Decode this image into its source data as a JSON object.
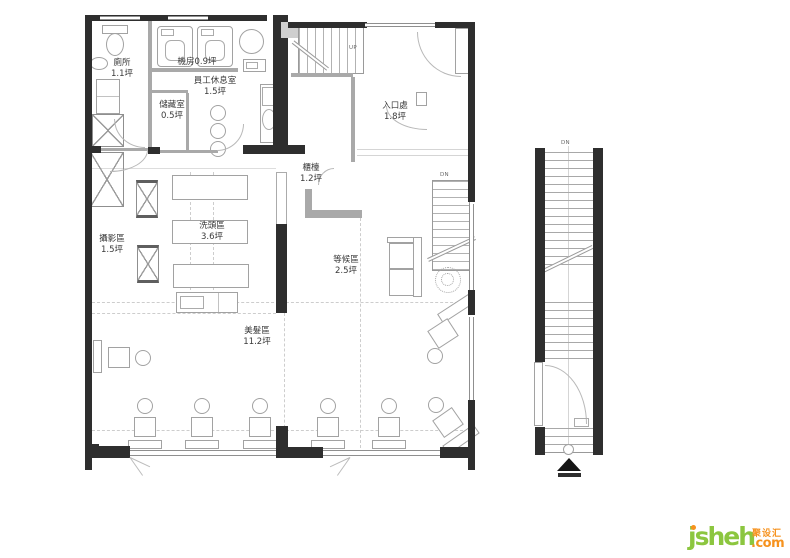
{
  "plan": {
    "rooms": {
      "toilet": {
        "label": "廁所",
        "area": "1.1坪"
      },
      "machine_room": {
        "label": "機房",
        "area": "0.9坪"
      },
      "staff_lounge": {
        "label": "員工休息室",
        "area": "1.5坪"
      },
      "storage": {
        "label": "儲藏室",
        "area": "0.5坪"
      },
      "entrance": {
        "label": "入口處",
        "area": "1.8坪"
      },
      "counter": {
        "label": "櫃檯",
        "area": "1.2坪"
      },
      "photo_area": {
        "label": "攝影區",
        "area": "1.5坪"
      },
      "shampoo_area": {
        "label": "洗頭區",
        "area": "3.6坪"
      },
      "waiting_area": {
        "label": "等候區",
        "area": "2.5坪"
      },
      "hair_area": {
        "label": "美髮區",
        "area": "11.2坪"
      }
    },
    "stairs": {
      "up": "UP",
      "down_main": "DN",
      "down_side": "DN"
    }
  },
  "logo": {
    "brand": "jsheh",
    "chinese": "聚设汇",
    "tld": ".com"
  },
  "colors": {
    "wall": "#2e2e2e",
    "wall_gray": "#a9a9a9",
    "logo_green": "#8cc63f",
    "logo_orange": "#f6921e"
  }
}
